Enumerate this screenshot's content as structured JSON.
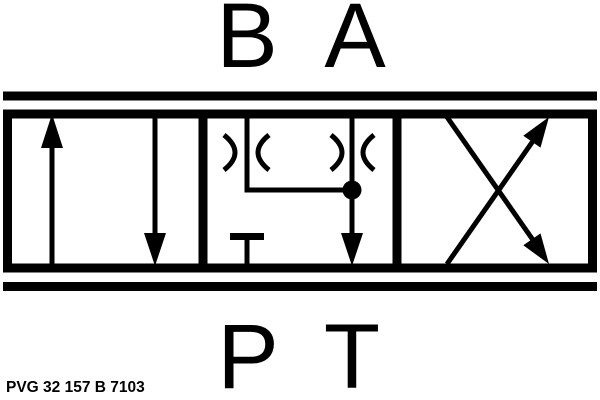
{
  "schematic": {
    "type": "hydraulic-directional-valve-symbol",
    "port_labels": {
      "top_left": "B",
      "top_right": "A",
      "bottom_left": "P",
      "bottom_right": "T"
    },
    "part_number": "PVG 32 157 B 7103",
    "colors": {
      "ink": "#000000",
      "background": "#ffffff"
    },
    "positions": [
      {
        "index": 0,
        "symbol": "parallel-arrows"
      },
      {
        "index": 1,
        "symbol": "float-with-orifices-p-blocked"
      },
      {
        "index": 2,
        "symbol": "crossed-arrows"
      }
    ]
  }
}
